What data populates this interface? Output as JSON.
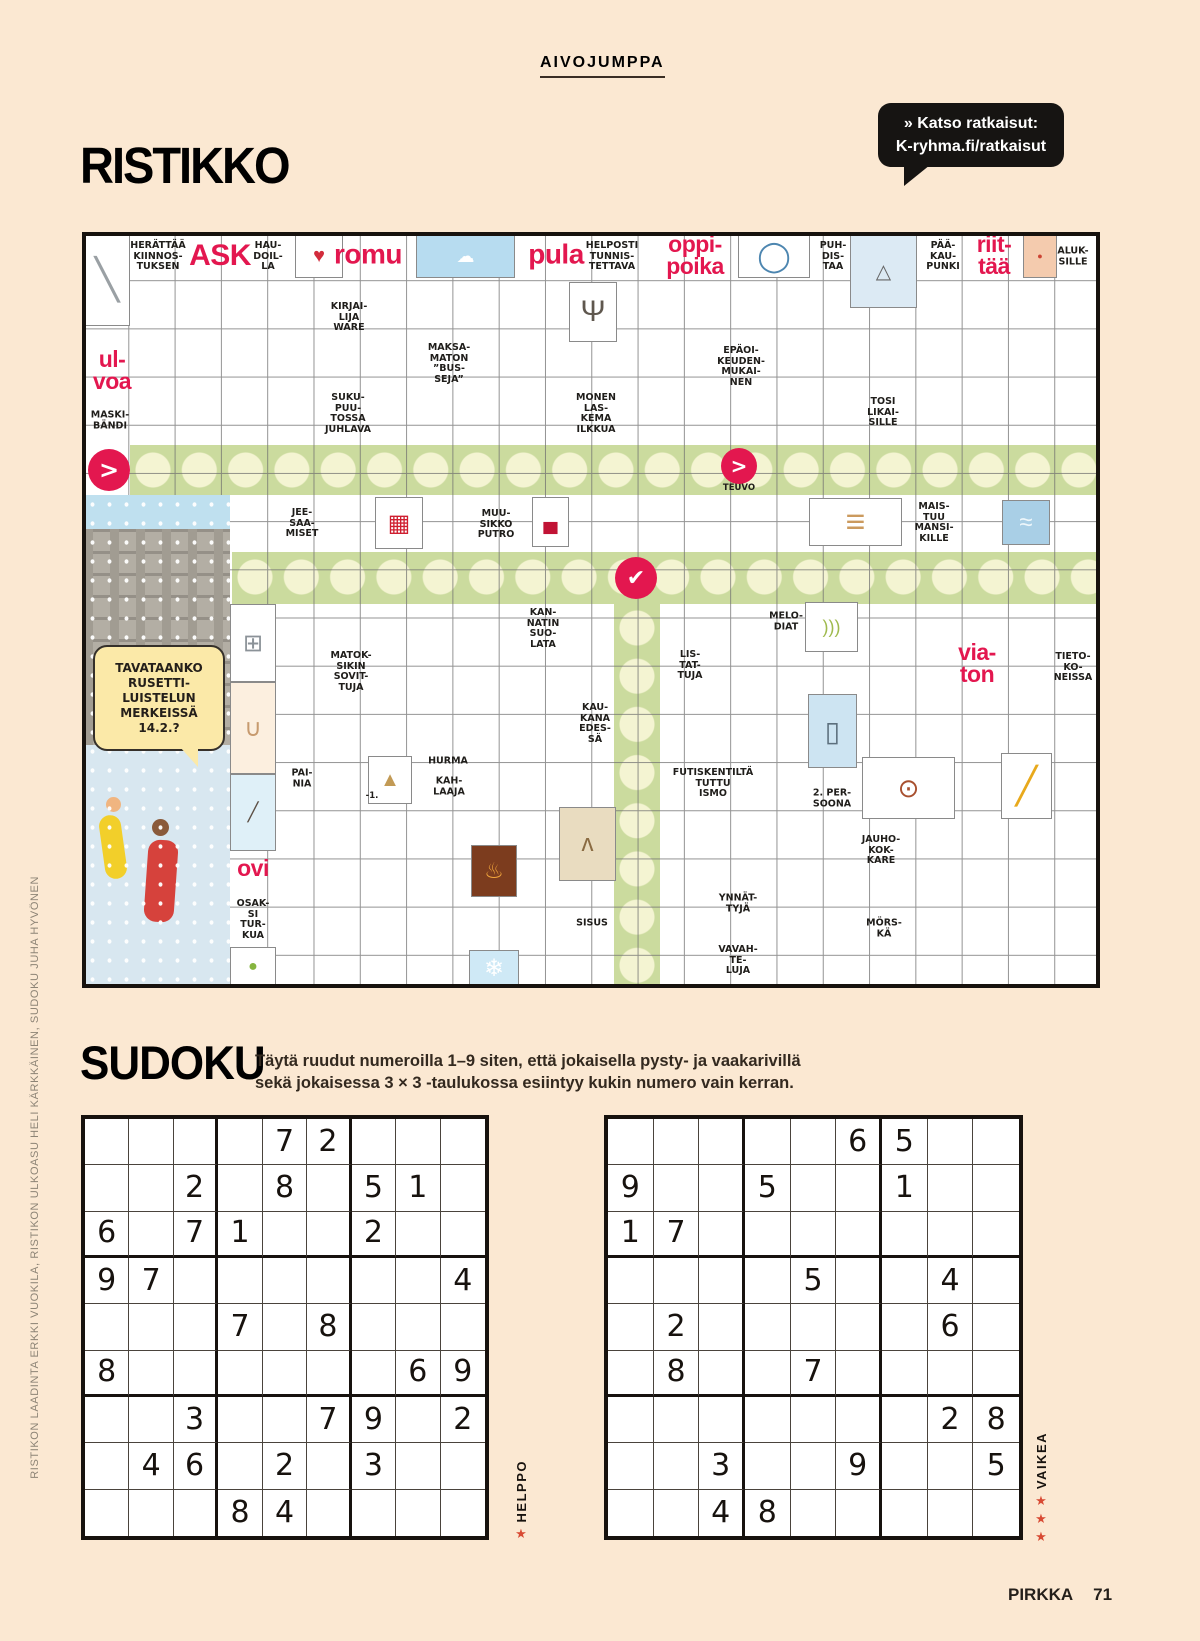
{
  "page": {
    "bg": "#fbe8d2",
    "accent_red": "#e3174f",
    "ink": "#17120e",
    "tag": "AIVOJUMPPA",
    "footer_brand": "PIRKKA",
    "footer_page": "71",
    "credit_vertical": "RISTIKON LAADINTA ERKKI VUOKILA, RISTIKON ULKOASU HELI KÄRKKÄINEN, SUDOKU JUHA HYVÖNEN"
  },
  "ristikko": {
    "title": "RISTIKKO",
    "bubble_line1": "» Katso ratkaisut:",
    "bubble_line2": "K-ryhma.fi/ratkaisut",
    "winter_bubble_text": "TAVATAANKO\nRUSETTI-\nLUISTELUN\nMERKEISSÄ\n14.2.?",
    "highlight_green": "#cbdb9e",
    "highlight_circle": "#f4f4d2",
    "highlights": [
      {
        "name": "answer-row-1",
        "x": 130,
        "y": 445,
        "w": 970,
        "h": 50,
        "dir": "h"
      },
      {
        "name": "answer-row-2",
        "x": 232,
        "y": 552,
        "w": 868,
        "h": 52,
        "dir": "h"
      },
      {
        "name": "answer-column",
        "x": 614,
        "y": 604,
        "w": 46,
        "h": 384,
        "dir": "v"
      }
    ],
    "arrows": [
      {
        "name": "arrow-circle-left",
        "x": 109,
        "y": 470,
        "r": 21,
        "glyph": ">",
        "fs": 24
      },
      {
        "name": "arrow-circle-teuvo",
        "x": 739,
        "y": 466,
        "r": 18,
        "glyph": ">",
        "fs": 20
      },
      {
        "name": "check-circle",
        "x": 636,
        "y": 578,
        "r": 21,
        "glyph": "✔",
        "fs": 22
      }
    ],
    "clues": [
      [
        "HERÄTTÄÄ\nKIINNOS-\nTUKSEN",
        158,
        257,
        "k"
      ],
      [
        "ASK",
        220,
        256,
        "r",
        30
      ],
      [
        "HAU-\nDOIL-\nLA",
        268,
        257,
        "k"
      ],
      [
        "romu",
        368,
        255,
        "r",
        28
      ],
      [
        "pula",
        556,
        255,
        "r",
        28
      ],
      [
        "HELPOSTI\nTUNNIS-\nTETTAVA",
        612,
        257,
        "k"
      ],
      [
        "oppi-\npoika",
        695,
        256,
        "r",
        23
      ],
      [
        "PUH-\nDIS-\nTAA",
        833,
        257,
        "k"
      ],
      [
        "PÄÄ-\nKAU-\nPUNKI",
        943,
        257,
        "k"
      ],
      [
        "riit-\ntää",
        994,
        256,
        "r",
        23
      ],
      [
        "ALUK-\nSILLE",
        1073,
        257,
        "k"
      ],
      [
        "KIRJAI-\nLIJA\nWARE",
        349,
        318,
        "k"
      ],
      [
        "MAKSA-\nMATON\n”BUS-\nSEJA”",
        449,
        364,
        "k"
      ],
      [
        "EPÄOI-\nKEUDEN-\nMUKAI-\nNEN",
        741,
        367,
        "k"
      ],
      [
        "ul-\nvoa",
        112,
        371,
        "r",
        23
      ],
      [
        "MASKI-\nBÄNDI",
        110,
        421,
        "k"
      ],
      [
        "SUKU-\nPUU-\nTOSSA\nJUHLAVA",
        348,
        414,
        "k"
      ],
      [
        "MONEN\nLAS-\nKEMA\nILKKUA",
        596,
        414,
        "k"
      ],
      [
        "TOSI\nLIKAI-\nSILLE",
        883,
        413,
        "k"
      ],
      [
        "TEUVO",
        739,
        489,
        "t"
      ],
      [
        "JEE-\nSAA-\nMISET",
        302,
        524,
        "k"
      ],
      [
        "MUU-\nSIKKO\nPUTRO",
        496,
        525,
        "k"
      ],
      [
        "MAIS-\nTUU\nMANSI-\nKILLE",
        934,
        523,
        "k"
      ],
      [
        "KAN-\nNATIN\nSUO-\nLATA",
        543,
        629,
        "k"
      ],
      [
        "MELO-\nDIAT",
        786,
        622,
        "k"
      ],
      [
        "MATOK-\nSIKIN\nSOVIT-\nTUJA",
        351,
        672,
        "k"
      ],
      [
        "LIS-\nTAT-\nTUJA",
        690,
        666,
        "k"
      ],
      [
        "via-\nton",
        977,
        664,
        "r",
        23
      ],
      [
        "TIETO-\nKO-\nNEISSA",
        1073,
        668,
        "k"
      ],
      [
        "KAU-\nKANA\nEDES-\nSÄ",
        595,
        724,
        "k"
      ],
      [
        "PAI-\nNIA",
        302,
        779,
        "k"
      ],
      [
        "HURMA",
        448,
        762,
        "k"
      ],
      [
        "KAH-\nLAAJA",
        449,
        787,
        "k"
      ],
      [
        "-1.",
        372,
        797,
        "t"
      ],
      [
        "FUTISKENTILTÄ\nTUTTU\nISMO",
        713,
        784,
        "k"
      ],
      [
        "2. PER-\nSOONA",
        832,
        799,
        "k"
      ],
      [
        "JAUHO-\nKOK-\nKARE",
        881,
        851,
        "k"
      ],
      [
        "ovi",
        253,
        869,
        "r",
        23
      ],
      [
        "YNNÄT-\nTYJÄ",
        738,
        904,
        "k"
      ],
      [
        "OSAK-\nSI\nTUR-\nKUA",
        253,
        920,
        "k"
      ],
      [
        "SISUS",
        592,
        924,
        "k"
      ],
      [
        "MÖRS-\nKÄ",
        884,
        929,
        "k"
      ],
      [
        "VAVAH-\nTE-\nLUJA",
        738,
        961,
        "k"
      ]
    ],
    "images": [
      [
        "scalpel-image",
        84,
        234,
        46,
        92,
        "#ffffff",
        "╲",
        "#9aa0a4",
        40
      ],
      [
        "playing-card-image",
        295,
        234,
        48,
        44,
        "#ffffff",
        "♥",
        "#d22c3c",
        20
      ],
      [
        "clay-shooter-image",
        416,
        234,
        99,
        44,
        "#b7dcf0",
        "☁",
        "#ffffff",
        18
      ],
      [
        "plate-image",
        738,
        234,
        72,
        44,
        "#ffffff",
        "◯",
        "#4d86b0",
        30
      ],
      [
        "climbers-image",
        850,
        234,
        67,
        74,
        "#dceaf4",
        "△",
        "#666666",
        20
      ],
      [
        "arm-image",
        1023,
        234,
        34,
        44,
        "#f4cbae",
        "●",
        "#cc4433",
        9
      ],
      [
        "tree-image",
        569,
        282,
        48,
        60,
        "#ffffff",
        "Ψ",
        "#5f574e",
        30
      ],
      [
        "basket-image",
        375,
        497,
        48,
        52,
        "#ffffff",
        "▦",
        "#cf1f30",
        24
      ],
      [
        "toy-car-image",
        532,
        497,
        37,
        50,
        "#ffffff",
        "▄",
        "#c11335",
        20
      ],
      [
        "planks-image",
        809,
        498,
        93,
        48,
        "#ffffff",
        "≡",
        "#cb9a5e",
        34
      ],
      [
        "sea-image",
        1002,
        500,
        48,
        45,
        "#a9cfe6",
        "≈",
        "#eef7fb",
        24
      ],
      [
        "kitchen-scale-image",
        230,
        604,
        46,
        78,
        "#ffffff",
        "⊞",
        "#8b9298",
        24
      ],
      [
        "bananas-image",
        805,
        602,
        53,
        50,
        "#ffffff",
        ")))",
        "#9fba4e",
        18
      ],
      [
        "cradle-image",
        230,
        682,
        46,
        92,
        "#fcefdf",
        "∪",
        "#c79a6e",
        24
      ],
      [
        "tower-image",
        808,
        694,
        49,
        74,
        "#cde4f2",
        "▯",
        "#5c6f7d",
        28
      ],
      [
        "sand-piles-image",
        368,
        756,
        44,
        48,
        "#ffffff",
        "▲",
        "#c29a55",
        20
      ],
      [
        "berry-scoop-image",
        862,
        757,
        93,
        62,
        "#ffffff",
        "⊙",
        "#a8502f",
        26
      ],
      [
        "pencil-image",
        1001,
        753,
        51,
        66,
        "#ffffff",
        "╱",
        "#e8a91c",
        36
      ],
      [
        "ice-fisher-image",
        230,
        774,
        46,
        77,
        "#dff0f8",
        "╱",
        "#5d5046",
        18
      ],
      [
        "lynx-image",
        559,
        807,
        57,
        74,
        "#e9dcc0",
        "ʌ",
        "#8a6b42",
        24
      ],
      [
        "fireplace-image",
        471,
        845,
        46,
        52,
        "#7c3c1e",
        "♨",
        "#f2a63c",
        22
      ],
      [
        "snowflake-image",
        469,
        950,
        50,
        36,
        "#cfe9f6",
        "❄",
        "#ffffff",
        24
      ],
      [
        "apple-hand-image",
        230,
        947,
        46,
        39,
        "#ffffff",
        "●",
        "#86b53f",
        16
      ]
    ]
  },
  "sudoku": {
    "title": "SUDOKU",
    "instructions_line1": "Täytä ruudut numeroilla 1–9 siten, että jokaisella pysty- ja vaakarivillä",
    "instructions_line2": "sekä jokaisessa 3 × 3 -taulukossa esiintyy kukin numero vain kerran.",
    "puzzles": [
      {
        "label": "HELPPO",
        "stars": 1,
        "grid": [
          "....72...",
          "..2.8.51.",
          "6.71..2..",
          "97......4",
          "...7.8...",
          "8......69",
          "..3..79.2",
          ".46.2.3..",
          "...84...."
        ]
      },
      {
        "label": "VAIKEA",
        "stars": 3,
        "grid": [
          ".....65..",
          "9..5..1..",
          "17.......",
          "....5..4.",
          ".2.....6.",
          ".8..7....",
          ".......28",
          "..3..9..5",
          "..48....."
        ]
      }
    ]
  }
}
